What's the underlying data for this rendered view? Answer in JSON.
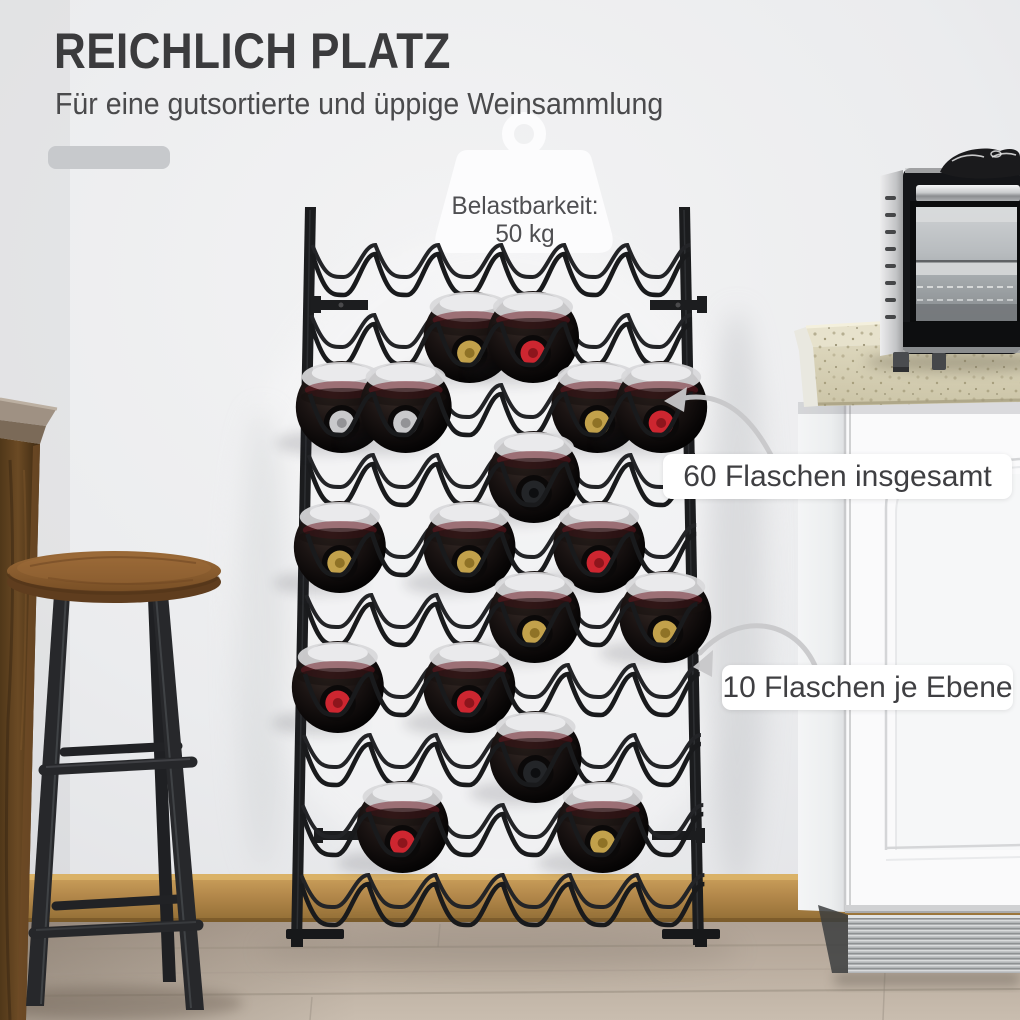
{
  "header": {
    "title": "REICHLICH PLATZ",
    "subtitle": "Für eine gutsortierte und üppige Weinsammlung"
  },
  "decor": {
    "accent_bar_color": "#c7c9cc"
  },
  "badge": {
    "icon": "weight-icon",
    "line1": "Belastbarkeit:",
    "line2": "50 kg"
  },
  "callouts": [
    {
      "text": "60 Flaschen insgesamt"
    },
    {
      "text": "10 Flaschen je Ebene"
    }
  ],
  "scene": {
    "objects": [
      "bar-table",
      "bar-stool",
      "wine-rack",
      "wine-bottles",
      "kitchen-cabinet",
      "countertop",
      "mini-oven",
      "oven-mitt",
      "wood-floor",
      "baseboard"
    ]
  },
  "rack": {
    "rows": [
      {
        "bottles": []
      },
      {
        "bottles": [
          {
            "slot": 2,
            "cap": "gold"
          },
          {
            "slot": 3,
            "cap": "red"
          }
        ]
      },
      {
        "bottles": [
          {
            "slot": 0,
            "cap": "silver"
          },
          {
            "slot": 1,
            "cap": "silver"
          },
          {
            "slot": 4,
            "cap": "gold"
          },
          {
            "slot": 5,
            "cap": "red"
          }
        ]
      },
      {
        "bottles": [
          {
            "slot": 3,
            "cap": "black"
          }
        ]
      },
      {
        "bottles": [
          {
            "slot": 0,
            "cap": "gold"
          },
          {
            "slot": 2,
            "cap": "gold"
          },
          {
            "slot": 4,
            "cap": "red"
          }
        ]
      },
      {
        "bottles": [
          {
            "slot": 3,
            "cap": "gold"
          },
          {
            "slot": 5,
            "cap": "gold"
          }
        ]
      },
      {
        "bottles": [
          {
            "slot": 0,
            "cap": "red"
          },
          {
            "slot": 2,
            "cap": "red"
          }
        ]
      },
      {
        "bottles": [
          {
            "slot": 3,
            "cap": "black"
          }
        ]
      },
      {
        "bottles": [
          {
            "slot": 1,
            "cap": "red"
          },
          {
            "slot": 4,
            "cap": "gold"
          }
        ]
      },
      {
        "bottles": []
      }
    ],
    "cap_colors": {
      "gold": {
        "main": "#c2a14b",
        "inner": "#8f7226"
      },
      "red": {
        "main": "#cd2630",
        "inner": "#8d151c"
      },
      "silver": {
        "main": "#c9c9cb",
        "inner": "#939396"
      },
      "black": {
        "main": "#232528",
        "inner": "#0d0e10"
      }
    }
  }
}
